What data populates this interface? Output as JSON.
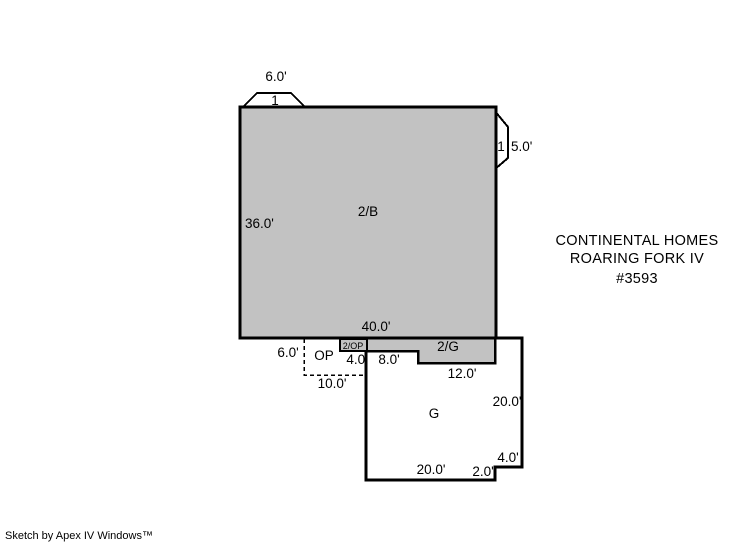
{
  "colors": {
    "area_fill": "#c2c2c2",
    "open_fill": "#ffffff",
    "line": "#000000",
    "background": "#ffffff"
  },
  "areas": {
    "main": {
      "label": "2/B",
      "side_dim": "36.0'",
      "bottom_dim": "40.0'"
    },
    "top_bay": {
      "label": "1",
      "dim": "6.0'"
    },
    "right_bay": {
      "label": "1",
      "dim": "5.0'"
    },
    "porch": {
      "label": "OP",
      "height_dim": "6.0'",
      "width_dim": "10.0'"
    },
    "porch_overhang": {
      "label": "2/OP",
      "width_dim": "4.0'"
    },
    "garage_overhang": {
      "label": "2/G",
      "left_dim": "8.0'",
      "bottom_dim": "12.0'"
    },
    "garage": {
      "label": "G",
      "right_dim": "20.0'",
      "bottom_dim": "20.0'",
      "notch_width_dim": "4.0'",
      "notch_height_dim": "2.0'"
    }
  },
  "annotation": {
    "line1": "CONTINENTAL HOMES",
    "line2": "ROARING FORK IV",
    "line3": "#3593"
  },
  "footer": {
    "credit": "Sketch by Apex IV Windows™"
  }
}
